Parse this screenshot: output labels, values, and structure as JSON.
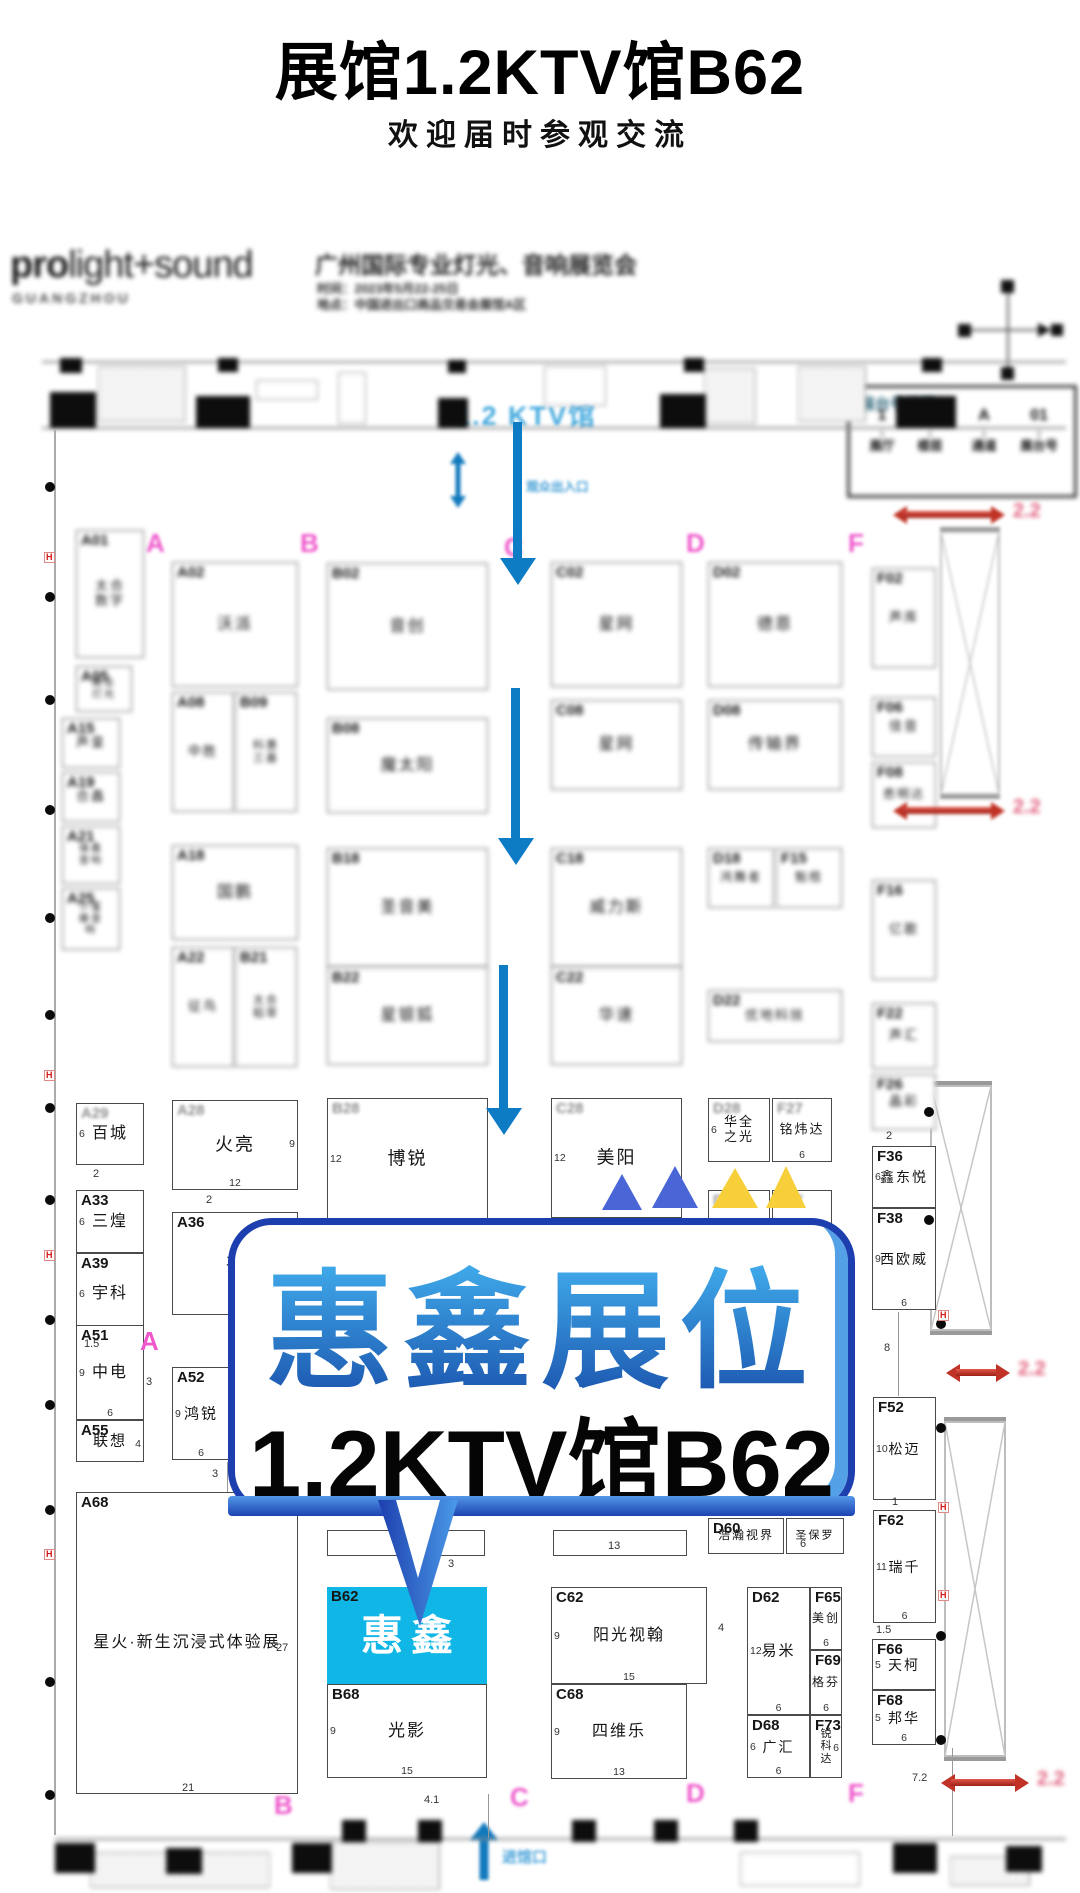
{
  "page": {
    "title": "展馆1.2KTV馆B62",
    "subtitle": "欢迎届时参观交流"
  },
  "header": {
    "logo_bold": "pro",
    "logo_rest": "light+sound",
    "logo_sub": "GUANGZHOU",
    "expo_title": "广州国际专业灯光、音响展览会",
    "expo_time": "时间：2023年5月22-25日",
    "expo_venue": "地点：中国进出口商品交易会展馆A区"
  },
  "legend": {
    "title": "展台号说明：",
    "separator": ".",
    "items": [
      {
        "code": "1",
        "label": "展厅"
      },
      {
        "code": "2",
        "label": "楼层"
      },
      {
        "code": "A",
        "label": "通道"
      },
      {
        "code": "01",
        "label": "展台号"
      }
    ]
  },
  "callout": {
    "line1": "惠鑫展位",
    "line2": "1.2KTV馆B62"
  },
  "map": {
    "hall_label": "1.2  KTV馆",
    "entrance_top": "观众出入口",
    "entrance_bottom": "进馆口",
    "red_arrow_label": "2.2",
    "letters": [
      {
        "t": "A",
        "x": 146,
        "y": 528,
        "blur": true
      },
      {
        "t": "B",
        "x": 300,
        "y": 528,
        "blur": true
      },
      {
        "t": "C",
        "x": 504,
        "y": 532,
        "blur": true
      },
      {
        "t": "D",
        "x": 686,
        "y": 528,
        "blur": true
      },
      {
        "t": "F",
        "x": 848,
        "y": 528,
        "blur": true
      },
      {
        "t": "A",
        "x": 140,
        "y": 1326,
        "blur": false
      },
      {
        "t": "B",
        "x": 274,
        "y": 1790,
        "blur": true
      },
      {
        "t": "C",
        "x": 510,
        "y": 1782,
        "blur": true
      },
      {
        "t": "D",
        "x": 686,
        "y": 1778,
        "blur": true
      },
      {
        "t": "F",
        "x": 848,
        "y": 1778,
        "blur": true
      }
    ],
    "booths": [
      {
        "id": "A01",
        "name": "太合数字",
        "x": 76,
        "y": 530,
        "w": 68,
        "h": 128,
        "blur": true,
        "two": true,
        "fs": 13
      },
      {
        "id": "A05",
        "name": "森业灯光",
        "x": 76,
        "y": 666,
        "w": 56,
        "h": 46,
        "blur": true,
        "two": true,
        "fs": 10
      },
      {
        "id": "A15",
        "name": "声皇",
        "x": 62,
        "y": 718,
        "w": 58,
        "h": 50,
        "blur": true,
        "fs": 13
      },
      {
        "id": "A19",
        "name": "合鑫",
        "x": 62,
        "y": 772,
        "w": 58,
        "h": 50,
        "blur": true,
        "fs": 13
      },
      {
        "id": "A21",
        "name": "锋鑫音响",
        "x": 62,
        "y": 826,
        "w": 58,
        "h": 58,
        "blur": true,
        "two": true,
        "fs": 10
      },
      {
        "id": "A25",
        "name": "小蜜蜂音响",
        "x": 62,
        "y": 888,
        "w": 58,
        "h": 62,
        "blur": true,
        "two": true,
        "fs": 10
      },
      {
        "id": "A02",
        "name": "沃派",
        "x": 172,
        "y": 562,
        "w": 126,
        "h": 125,
        "blur": true
      },
      {
        "id": "B02",
        "name": "音创",
        "x": 327,
        "y": 563,
        "w": 161,
        "h": 127,
        "blur": true
      },
      {
        "id": "C02",
        "name": "星网",
        "x": 551,
        "y": 562,
        "w": 131,
        "h": 125,
        "blur": true
      },
      {
        "id": "D02",
        "name": "德恩",
        "x": 708,
        "y": 562,
        "w": 134,
        "h": 125,
        "blur": true
      },
      {
        "id": "F02",
        "name": "声库",
        "x": 872,
        "y": 568,
        "w": 64,
        "h": 100,
        "blur": true,
        "fs": 13
      },
      {
        "id": "A08",
        "name": "中胜",
        "x": 172,
        "y": 692,
        "w": 62,
        "h": 120,
        "blur": true,
        "fs": 13
      },
      {
        "id": "B09",
        "name": "科惠三基",
        "x": 235,
        "y": 692,
        "w": 62,
        "h": 120,
        "blur": true,
        "two": true,
        "fs": 11
      },
      {
        "id": "B08",
        "name": "魔太阳",
        "x": 327,
        "y": 718,
        "w": 161,
        "h": 95,
        "blur": true
      },
      {
        "id": "C08",
        "name": "星网",
        "x": 551,
        "y": 700,
        "w": 131,
        "h": 90,
        "blur": true
      },
      {
        "id": "D08",
        "name": "传输界",
        "x": 708,
        "y": 700,
        "w": 134,
        "h": 90,
        "blur": true
      },
      {
        "id": "F06",
        "name": "佳音",
        "x": 872,
        "y": 697,
        "w": 64,
        "h": 60,
        "blur": true,
        "fs": 13
      },
      {
        "id": "F08",
        "name": "悉明达",
        "x": 872,
        "y": 762,
        "w": 64,
        "h": 66,
        "blur": true,
        "fs": 12
      },
      {
        "id": "A18",
        "name": "国鹏",
        "x": 172,
        "y": 845,
        "w": 126,
        "h": 95,
        "blur": true
      },
      {
        "id": "B18",
        "name": "圣音美",
        "x": 327,
        "y": 848,
        "w": 161,
        "h": 119,
        "blur": true
      },
      {
        "id": "C18",
        "name": "威力斯",
        "x": 551,
        "y": 848,
        "w": 131,
        "h": 119,
        "blur": true
      },
      {
        "id": "D18",
        "name": "鸿舞者",
        "x": 708,
        "y": 848,
        "w": 66,
        "h": 60,
        "blur": true,
        "fs": 12
      },
      {
        "id": "F15",
        "name": "魁梧",
        "x": 776,
        "y": 848,
        "w": 66,
        "h": 60,
        "blur": true,
        "fs": 12
      },
      {
        "id": "F16",
        "name": "亿歌",
        "x": 872,
        "y": 880,
        "w": 64,
        "h": 100,
        "blur": true,
        "fs": 13
      },
      {
        "id": "A22",
        "name": "征鸟",
        "x": 172,
        "y": 947,
        "w": 62,
        "h": 120,
        "blur": true,
        "fs": 13
      },
      {
        "id": "B21",
        "name": "太合稻草",
        "x": 235,
        "y": 947,
        "w": 62,
        "h": 120,
        "blur": true,
        "two": true,
        "fs": 11
      },
      {
        "id": "B22",
        "name": "星银狐",
        "x": 327,
        "y": 967,
        "w": 161,
        "h": 98,
        "blur": true
      },
      {
        "id": "C22",
        "name": "华速",
        "x": 551,
        "y": 967,
        "w": 131,
        "h": 98,
        "blur": true
      },
      {
        "id": "D22",
        "name": "优地科技",
        "x": 708,
        "y": 990,
        "w": 134,
        "h": 52,
        "blur": true,
        "fs": 13
      },
      {
        "id": "F22",
        "name": "声汇",
        "x": 872,
        "y": 1003,
        "w": 64,
        "h": 66,
        "blur": true,
        "fs": 13
      },
      {
        "id": "F26",
        "name": "晶彩",
        "x": 872,
        "y": 1074,
        "w": 64,
        "h": 56,
        "blur": true,
        "fs": 13
      },
      {
        "id": "A29",
        "name": "百城",
        "x": 76,
        "y": 1103,
        "w": 68,
        "h": 62,
        "dl": "6",
        "lb": true,
        "fs": 16
      },
      {
        "id": "A28",
        "name": "火亮",
        "x": 172,
        "y": 1100,
        "w": 126,
        "h": 90,
        "dr": "9",
        "db": "12",
        "lb": true,
        "fs": 18
      },
      {
        "id": "B28",
        "name": "博锐",
        "x": 327,
        "y": 1098,
        "w": 161,
        "h": 122,
        "dl": "12",
        "lb": true,
        "fs": 18
      },
      {
        "id": "C28",
        "name": "美阳",
        "x": 551,
        "y": 1098,
        "w": 131,
        "h": 120,
        "dl": "12",
        "lb": true,
        "fs": 18
      },
      {
        "id": "D28",
        "name": "华全之光",
        "x": 708,
        "y": 1098,
        "w": 62,
        "h": 64,
        "dl": "6",
        "lb": true,
        "two": true,
        "fs": 13
      },
      {
        "id": "F27",
        "name": "铭炜达",
        "x": 772,
        "y": 1098,
        "w": 60,
        "h": 64,
        "db": "6",
        "lb": true,
        "fs": 13
      },
      {
        "id": "D30",
        "name": "",
        "x": 708,
        "y": 1190,
        "w": 62,
        "h": 40,
        "lb": true
      },
      {
        "id": "F37",
        "name": "",
        "x": 772,
        "y": 1190,
        "w": 60,
        "h": 40,
        "lb": true
      },
      {
        "id": "F36",
        "name": "鑫东悦",
        "x": 872,
        "y": 1146,
        "w": 64,
        "h": 62,
        "dl": "6",
        "fs": 14
      },
      {
        "id": "F38",
        "name": "西欧威",
        "x": 872,
        "y": 1208,
        "w": 64,
        "h": 102,
        "dl": "9",
        "db": "6",
        "fs": 14
      },
      {
        "id": "A33",
        "name": "三煌",
        "x": 76,
        "y": 1190,
        "w": 68,
        "h": 63,
        "dl": "6",
        "fs": 16
      },
      {
        "id": "A39",
        "name": "宇科",
        "x": 76,
        "y": 1253,
        "w": 68,
        "h": 82,
        "dl": "6",
        "fs": 16
      },
      {
        "id": "A36",
        "name": "丰",
        "x": 172,
        "y": 1212,
        "w": 126,
        "h": 103,
        "fs": 16
      },
      {
        "id": "A51",
        "name": "中电",
        "x": 76,
        "y": 1325,
        "w": 68,
        "h": 95,
        "dl": "9",
        "db": "6",
        "fs": 16
      },
      {
        "id": "A55",
        "name": "联想",
        "x": 76,
        "y": 1420,
        "w": 68,
        "h": 42,
        "dr": "4",
        "fs": 15
      },
      {
        "id": "A52",
        "name": "鸿锐",
        "x": 172,
        "y": 1367,
        "w": 58,
        "h": 93,
        "dl": "9",
        "db": "6",
        "fs": 15
      },
      {
        "id": "A68",
        "name": "星火·新生沉浸式体验展",
        "x": 76,
        "y": 1492,
        "w": 222,
        "h": 302,
        "fs": 16
      },
      {
        "id": "D60",
        "name": "浩瀚视界",
        "x": 708,
        "y": 1518,
        "w": 76,
        "h": 36,
        "fs": 12
      },
      {
        "id": "",
        "name": "圣保罗",
        "x": 786,
        "y": 1518,
        "w": 58,
        "h": 36,
        "fs": 11
      },
      {
        "id": "",
        "name": "",
        "x": 327,
        "y": 1530,
        "w": 158,
        "h": 26
      },
      {
        "id": "",
        "name": "",
        "x": 553,
        "y": 1530,
        "w": 134,
        "h": 26
      },
      {
        "id": "B62",
        "name": "惠鑫",
        "x": 327,
        "y": 1587,
        "w": 160,
        "h": 97,
        "fill": "#10b7e6",
        "white": true,
        "fs": 42
      },
      {
        "id": "B68",
        "name": "光影",
        "x": 327,
        "y": 1684,
        "w": 160,
        "h": 94,
        "dl": "9",
        "db": "15",
        "fs": 17
      },
      {
        "id": "C62",
        "name": "阳光视翰",
        "x": 551,
        "y": 1587,
        "w": 156,
        "h": 97,
        "dl": "9",
        "db": "15",
        "fs": 16
      },
      {
        "id": "C68",
        "name": "四维乐",
        "x": 551,
        "y": 1684,
        "w": 136,
        "h": 95,
        "dl": "9",
        "db": "13",
        "fs": 16
      },
      {
        "id": "D62",
        "name": "易米",
        "x": 747,
        "y": 1587,
        "w": 63,
        "h": 128,
        "dl": "12",
        "db": "6",
        "fs": 15
      },
      {
        "id": "F65",
        "name": "美创",
        "x": 810,
        "y": 1587,
        "w": 32,
        "h": 63,
        "db": "6",
        "fs": 12
      },
      {
        "id": "F69",
        "name": "格芬",
        "x": 810,
        "y": 1650,
        "w": 32,
        "h": 65,
        "db": "6",
        "fs": 12
      },
      {
        "id": "D68",
        "name": "广汇",
        "x": 747,
        "y": 1715,
        "w": 63,
        "h": 63,
        "dl": "6",
        "db": "6",
        "fs": 14
      },
      {
        "id": "F73",
        "name": "锐科达",
        "x": 810,
        "y": 1715,
        "w": 32,
        "h": 63,
        "dr": "6",
        "vert": true,
        "fs": 11
      },
      {
        "id": "F52",
        "name": "松迈",
        "x": 873,
        "y": 1397,
        "w": 63,
        "h": 103,
        "dl": "10",
        "fs": 14
      },
      {
        "id": "F62",
        "name": "瑞千",
        "x": 873,
        "y": 1510,
        "w": 63,
        "h": 113,
        "dl": "11",
        "db": "6",
        "fs": 14
      },
      {
        "id": "F66",
        "name": "天柯",
        "x": 872,
        "y": 1639,
        "w": 64,
        "h": 51,
        "dl": "5",
        "fs": 14
      },
      {
        "id": "F68",
        "name": "邦华",
        "x": 872,
        "y": 1690,
        "w": 64,
        "h": 55,
        "dl": "5",
        "db": "6",
        "fs": 14
      }
    ],
    "annotations": [
      {
        "t": "2",
        "x": 93,
        "y": 1168
      },
      {
        "t": "2",
        "x": 206,
        "y": 1194
      },
      {
        "t": "1.5",
        "x": 84,
        "y": 1338
      },
      {
        "t": "3",
        "x": 146,
        "y": 1376
      },
      {
        "t": "3",
        "x": 212,
        "y": 1468
      },
      {
        "t": "3",
        "x": 448,
        "y": 1558
      },
      {
        "t": "13",
        "x": 608,
        "y": 1540
      },
      {
        "t": "4",
        "x": 718,
        "y": 1622
      },
      {
        "t": "8",
        "x": 884,
        "y": 1342
      },
      {
        "t": "1",
        "x": 892,
        "y": 1496
      },
      {
        "t": "1.5",
        "x": 876,
        "y": 1624
      },
      {
        "t": "7.2",
        "x": 912,
        "y": 1772
      },
      {
        "t": "4.1",
        "x": 424,
        "y": 1794
      },
      {
        "t": "2",
        "x": 886,
        "y": 1130
      },
      {
        "t": "6",
        "x": 800,
        "y": 1538
      },
      {
        "t": "27",
        "x": 276,
        "y": 1642
      },
      {
        "t": "21",
        "x": 182,
        "y": 1782
      }
    ],
    "blue_arrows": [
      {
        "x": 513,
        "y": 422,
        "h": 163
      },
      {
        "x": 511,
        "y": 688,
        "h": 177
      },
      {
        "x": 499,
        "y": 965,
        "h": 170
      }
    ],
    "red_arrows": [
      {
        "x": 893,
        "y": 506,
        "w": 112,
        "blur": true
      },
      {
        "x": 893,
        "y": 802,
        "w": 112,
        "blur": true
      },
      {
        "x": 946,
        "y": 1364,
        "w": 64,
        "blur": false
      },
      {
        "x": 941,
        "y": 1774,
        "w": 88,
        "blur": false
      }
    ],
    "triangles": [
      {
        "x": 602,
        "y": 1174,
        "w": 40,
        "h": 36,
        "c": "#4a66d6"
      },
      {
        "x": 652,
        "y": 1166,
        "w": 46,
        "h": 42,
        "c": "#4a66d6"
      },
      {
        "x": 712,
        "y": 1168,
        "w": 46,
        "h": 40,
        "c": "#f6cf3a"
      },
      {
        "x": 766,
        "y": 1166,
        "w": 40,
        "h": 42,
        "c": "#f6cf3a"
      }
    ]
  },
  "colors": {
    "accent_blue": "#0e7cc4",
    "booth_highlight": "#10b7e6",
    "magenta": "#ee58cc",
    "red_arrow": "#c03225",
    "pink_label": "#e0607c",
    "callout_border": "#1c3eae",
    "callout_text_gradient": [
      "#47bbf6",
      "#1a52ac"
    ]
  }
}
